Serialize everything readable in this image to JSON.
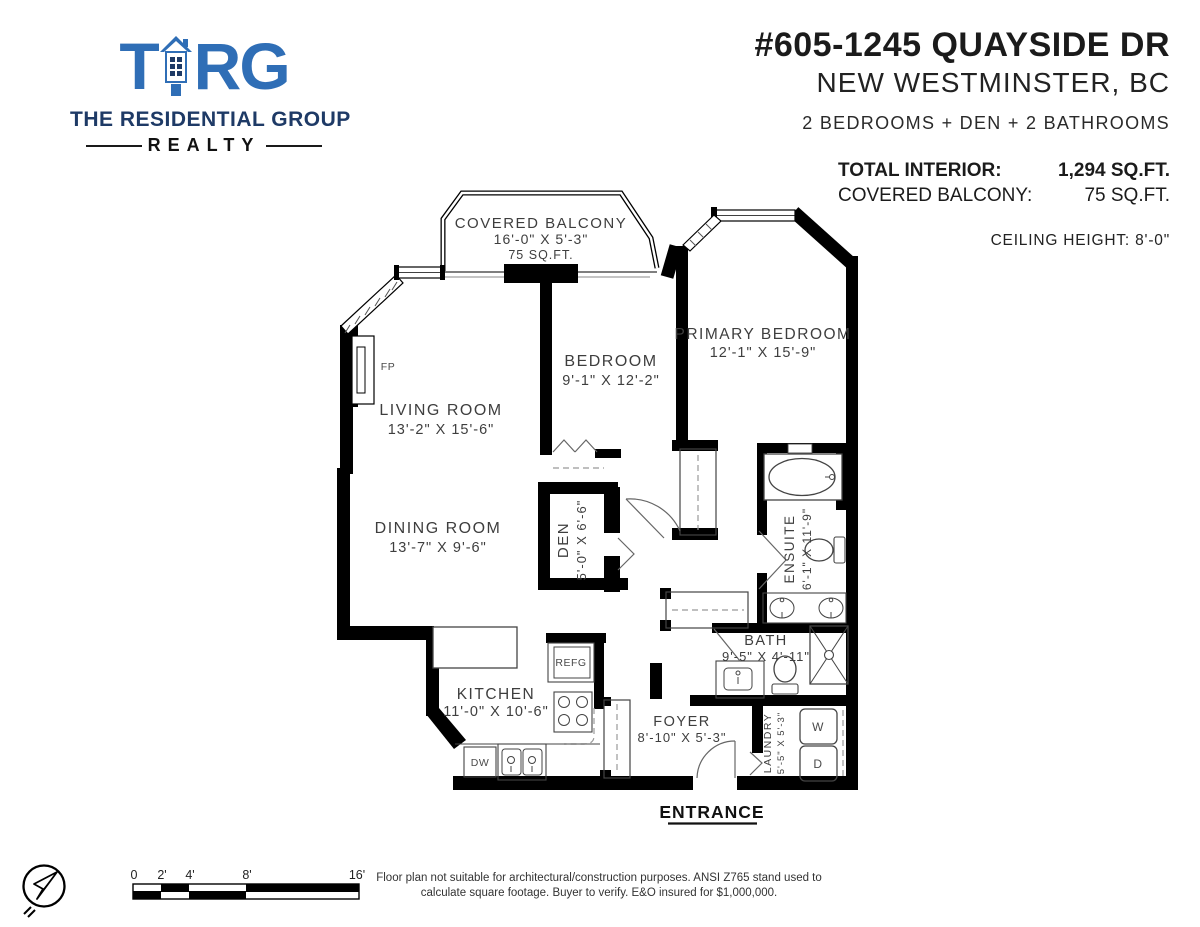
{
  "logo": {
    "brand_t": "T",
    "brand_rg": "RG",
    "line1": "THE RESIDENTIAL GROUP",
    "line2": "REALTY",
    "colors": {
      "blue": "#2f6eb6",
      "navy": "#1e3a66"
    }
  },
  "header": {
    "address_line1": "#605-1245 QUAYSIDE DR",
    "address_line2": "NEW WESTMINSTER, BC",
    "summary": "2 BEDROOMS + DEN + 2 BATHROOMS",
    "total_interior_label": "TOTAL INTERIOR:",
    "total_interior_value": "1,294 SQ.FT.",
    "covered_balcony_label": "COVERED BALCONY:",
    "covered_balcony_value": "75 SQ.FT.",
    "ceiling_height": "CEILING HEIGHT: 8'-0\""
  },
  "rooms": {
    "covered_balcony": {
      "name": "COVERED BALCONY",
      "dims": "16'-0\" X 5'-3\"",
      "area": "75 SQ.FT."
    },
    "living_room": {
      "name": "LIVING ROOM",
      "dims": "13'-2\" X 15'-6\""
    },
    "dining_room": {
      "name": "DINING ROOM",
      "dims": "13'-7\" X 9'-6\""
    },
    "bedroom": {
      "name": "BEDROOM",
      "dims": "9'-1\" X 12'-2\""
    },
    "primary_bedroom": {
      "name": "PRIMARY BEDROOM",
      "dims": "12'-1\" X 15'-9\""
    },
    "den": {
      "name": "DEN",
      "dims": "5'-0\" X 6'-6\""
    },
    "ensuite": {
      "name": "ENSUITE",
      "dims": "6'-1\" X 11'-9\""
    },
    "bath": {
      "name": "BATH",
      "dims": "9'-5\" X 4'-11\""
    },
    "kitchen": {
      "name": "KITCHEN",
      "dims": "11'-0\" X 10'-6\""
    },
    "foyer": {
      "name": "FOYER",
      "dims": "8'-10\" X 5'-3\""
    },
    "laundry": {
      "name": "LAUNDRY",
      "dims": "5'-5\" X 5'-3\""
    }
  },
  "fixtures": {
    "fireplace": "FP",
    "fridge": "REFG",
    "dishwasher": "DW",
    "washer": "W",
    "dryer": "D"
  },
  "entrance_label": "ENTRANCE",
  "scale_bar": {
    "labels": [
      "0",
      "2'",
      "4'",
      "8'",
      "16'"
    ]
  },
  "footer": {
    "disclaimer_line1": "Floor plan not suitable for architectural/construction purposes. ANSI Z765 stand used to",
    "disclaimer_line2": "calculate square footage. Buyer to verify.  E&O insured for $1,000,000."
  }
}
